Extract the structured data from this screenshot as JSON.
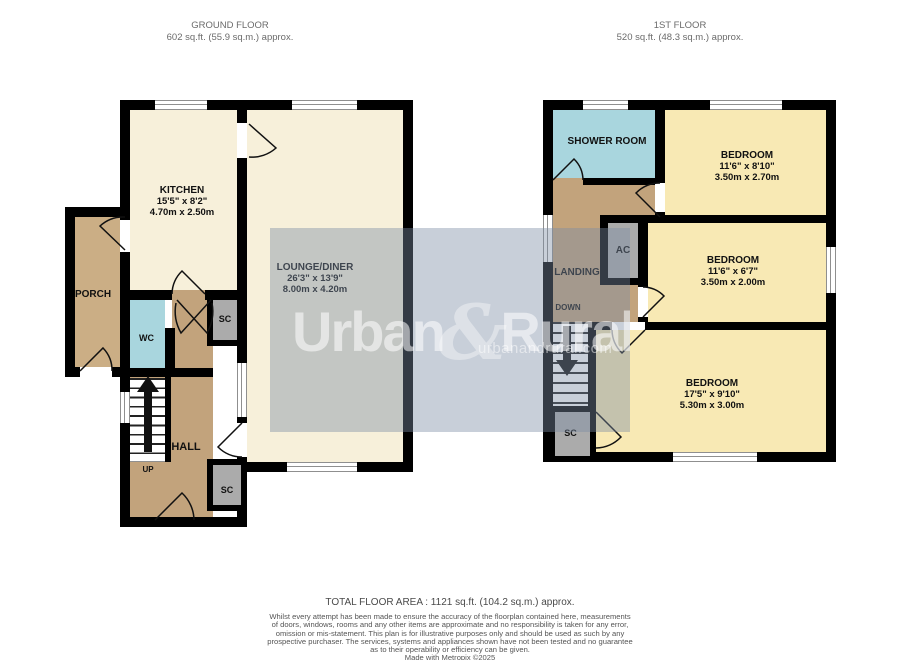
{
  "header": {
    "ground": {
      "title": "GROUND FLOOR",
      "area": "602 sq.ft. (55.9 sq.m.) approx."
    },
    "first": {
      "title": "1ST FLOOR",
      "area": "520 sq.ft. (48.3 sq.m.) approx."
    }
  },
  "ground_floor": {
    "kitchen": {
      "name": "KITCHEN",
      "imperial": "15'5\" x 8'2\"",
      "metric": "4.70m x 2.50m"
    },
    "lounge": {
      "name": "LOUNGE/DINER",
      "imperial": "26'3\" x 13'9\"",
      "metric": "8.00m x 4.20m"
    },
    "porch": "PORCH",
    "wc": "WC",
    "sc_top": "SC",
    "sc_bottom": "SC",
    "hall": "HALL",
    "up": "UP"
  },
  "first_floor": {
    "shower": "SHOWER ROOM",
    "bedroom1": {
      "name": "BEDROOM",
      "imperial": "11'6\" x 8'10\"",
      "metric": "3.50m x 2.70m"
    },
    "bedroom2": {
      "name": "BEDROOM",
      "imperial": "11'6\" x 6'7\"",
      "metric": "3.50m x 2.00m"
    },
    "bedroom3": {
      "name": "BEDROOM",
      "imperial": "17'5\" x 9'10\"",
      "metric": "5.30m x 3.00m"
    },
    "landing": "LANDING",
    "ac": "AC",
    "down": "DOWN",
    "sc": "SC"
  },
  "watermark": {
    "brand_left": "Urban",
    "ampersand": "&",
    "brand_right": "Rural",
    "site": "urbanandrural.com"
  },
  "footer": {
    "total": "TOTAL FLOOR AREA : 1121 sq.ft. (104.2 sq.m.) approx.",
    "disclaimer_lines": [
      "Whilst every attempt has been made to ensure the accuracy of the floorplan contained here, measurements",
      "of doors, windows, rooms and any other items are approximate and no responsibility is taken for any error,",
      "omission or mis-statement. This plan is for illustrative purposes only and should be used as such by any",
      "prospective purchaser. The services, systems and appliances shown have not been tested and no guarantee",
      "as to their operability or efficiency can be given."
    ],
    "credit": "Made with Metropix ©2025"
  },
  "colors": {
    "wall": "#000000",
    "cream_room": "#F7F0DA",
    "bedroom_yellow": "#F8E9B4",
    "hall_brown": "#C2A37C",
    "porch_brown": "#CBAE85",
    "wet_room_blue": "#A9D6DE",
    "cupboard_gray": "#ABABAB",
    "watermark_overlay": "rgba(125,140,165,0.42)"
  }
}
